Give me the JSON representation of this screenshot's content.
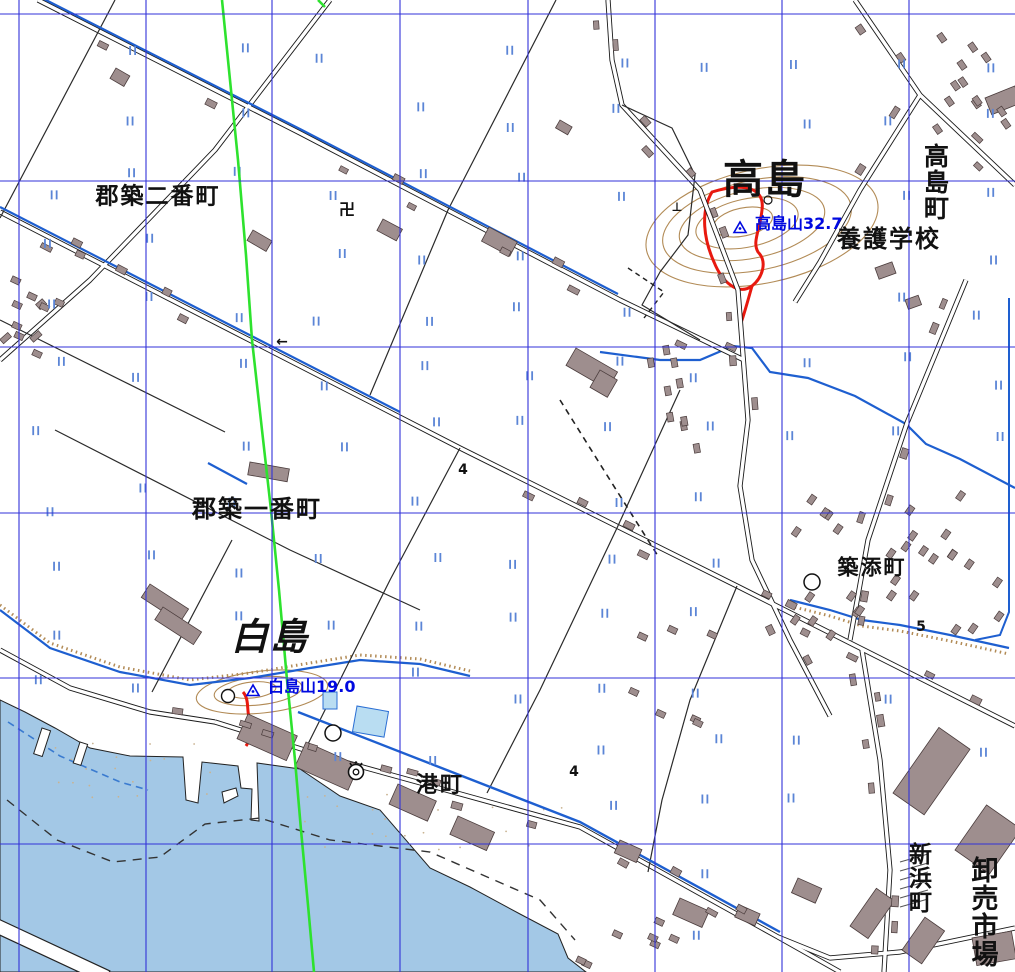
{
  "map_colors": {
    "background": "#ffffff",
    "sea": "#a3c8e6",
    "pool": "#b9ddf2",
    "grid": "#3232d8",
    "route": "#2ee22e",
    "road_casing": "#1a1a1a",
    "water_line": "#1e5fd0",
    "paddy_mark": "#5b85d6",
    "contour": "#b28b56",
    "building": "#9e8e8e",
    "building_edge": "#4a3c3c",
    "red_boundary": "#e8190f",
    "label_ink": "#111111",
    "peak_label": "#0009e0",
    "sand_dot": "#c9b391"
  },
  "place_labels": [
    {
      "id": "gunchiku-niban-cho",
      "text": "郡築二番町",
      "x": 158,
      "y": 197,
      "size": 23,
      "vertical": false,
      "italic": false
    },
    {
      "id": "gunchiku-ichiban-cho",
      "text": "郡築一番町",
      "x": 257,
      "y": 509,
      "size": 24,
      "vertical": false,
      "italic": false
    },
    {
      "id": "takashima",
      "text": "高島",
      "x": 765,
      "y": 180,
      "size": 40,
      "vertical": false,
      "italic": false
    },
    {
      "id": "shirashima",
      "text": "白島",
      "x": 270,
      "y": 637,
      "size": 37,
      "vertical": false,
      "italic": true
    },
    {
      "id": "takashima-cho",
      "text": "高島町",
      "x": 935,
      "y": 182,
      "size": 25,
      "vertical": true,
      "italic": false
    },
    {
      "id": "yogo-gakko",
      "text": "養護学校",
      "x": 889,
      "y": 239,
      "size": 24,
      "vertical": false,
      "italic": false
    },
    {
      "id": "tsukizoe-cho",
      "text": "築添町",
      "x": 872,
      "y": 568,
      "size": 21,
      "vertical": false,
      "italic": false
    },
    {
      "id": "minato-machi",
      "text": "港町",
      "x": 440,
      "y": 786,
      "size": 22,
      "vertical": false,
      "italic": false
    },
    {
      "id": "niihama-machi",
      "text": "新浜町",
      "x": 917,
      "y": 878,
      "size": 23,
      "vertical": true,
      "italic": false
    },
    {
      "id": "oroshiuri-ichiba",
      "text": "卸売市場",
      "x": 982,
      "y": 912,
      "size": 27,
      "vertical": true,
      "italic": false
    }
  ],
  "peak_labels": [
    {
      "id": "takashima-yama",
      "text": "高島山32.7",
      "x": 748,
      "y": 226,
      "tri_x": 740,
      "tri_y": 228,
      "size": 16
    },
    {
      "id": "shirashima-yama",
      "text": "白島山19.0",
      "x": 261,
      "y": 689,
      "tri_x": 253,
      "tri_y": 691,
      "size": 16
    }
  ],
  "spot_elevations": [
    {
      "text": "4",
      "x": 463,
      "y": 470
    },
    {
      "text": "4",
      "x": 574,
      "y": 772
    },
    {
      "text": "5",
      "x": 921,
      "y": 627
    }
  ],
  "map_symbols": [
    {
      "name": "temple-icon",
      "glyph": "卍",
      "x": 347,
      "y": 210,
      "size": 16
    },
    {
      "name": "grave-mark-icon",
      "glyph": "⊥",
      "x": 677,
      "y": 207,
      "size": 12
    },
    {
      "name": "flow-arrow-icon",
      "glyph": "←",
      "x": 282,
      "y": 342,
      "size": 14
    },
    {
      "name": "post-office-icon",
      "x": 333,
      "y": 733
    },
    {
      "name": "post-office-icon",
      "x": 812,
      "y": 582
    },
    {
      "name": "power-station-icon",
      "x": 356,
      "y": 772
    }
  ],
  "grid": {
    "vertical_x": [
      19,
      146,
      272,
      400,
      528,
      655,
      782,
      909
    ],
    "horizontal_y": [
      14,
      181,
      347,
      513,
      678,
      844
    ]
  },
  "route": {
    "points": [
      [
        222,
        0
      ],
      [
        232,
        100
      ],
      [
        238,
        160
      ],
      [
        246,
        255
      ],
      [
        252,
        340
      ],
      [
        262,
        430
      ],
      [
        271,
        510
      ],
      [
        279,
        590
      ],
      [
        287,
        680
      ],
      [
        295,
        760
      ],
      [
        301,
        830
      ],
      [
        308,
        905
      ],
      [
        314,
        972
      ]
    ],
    "corner_segment": [
      [
        318,
        0
      ],
      [
        325,
        7
      ]
    ]
  }
}
